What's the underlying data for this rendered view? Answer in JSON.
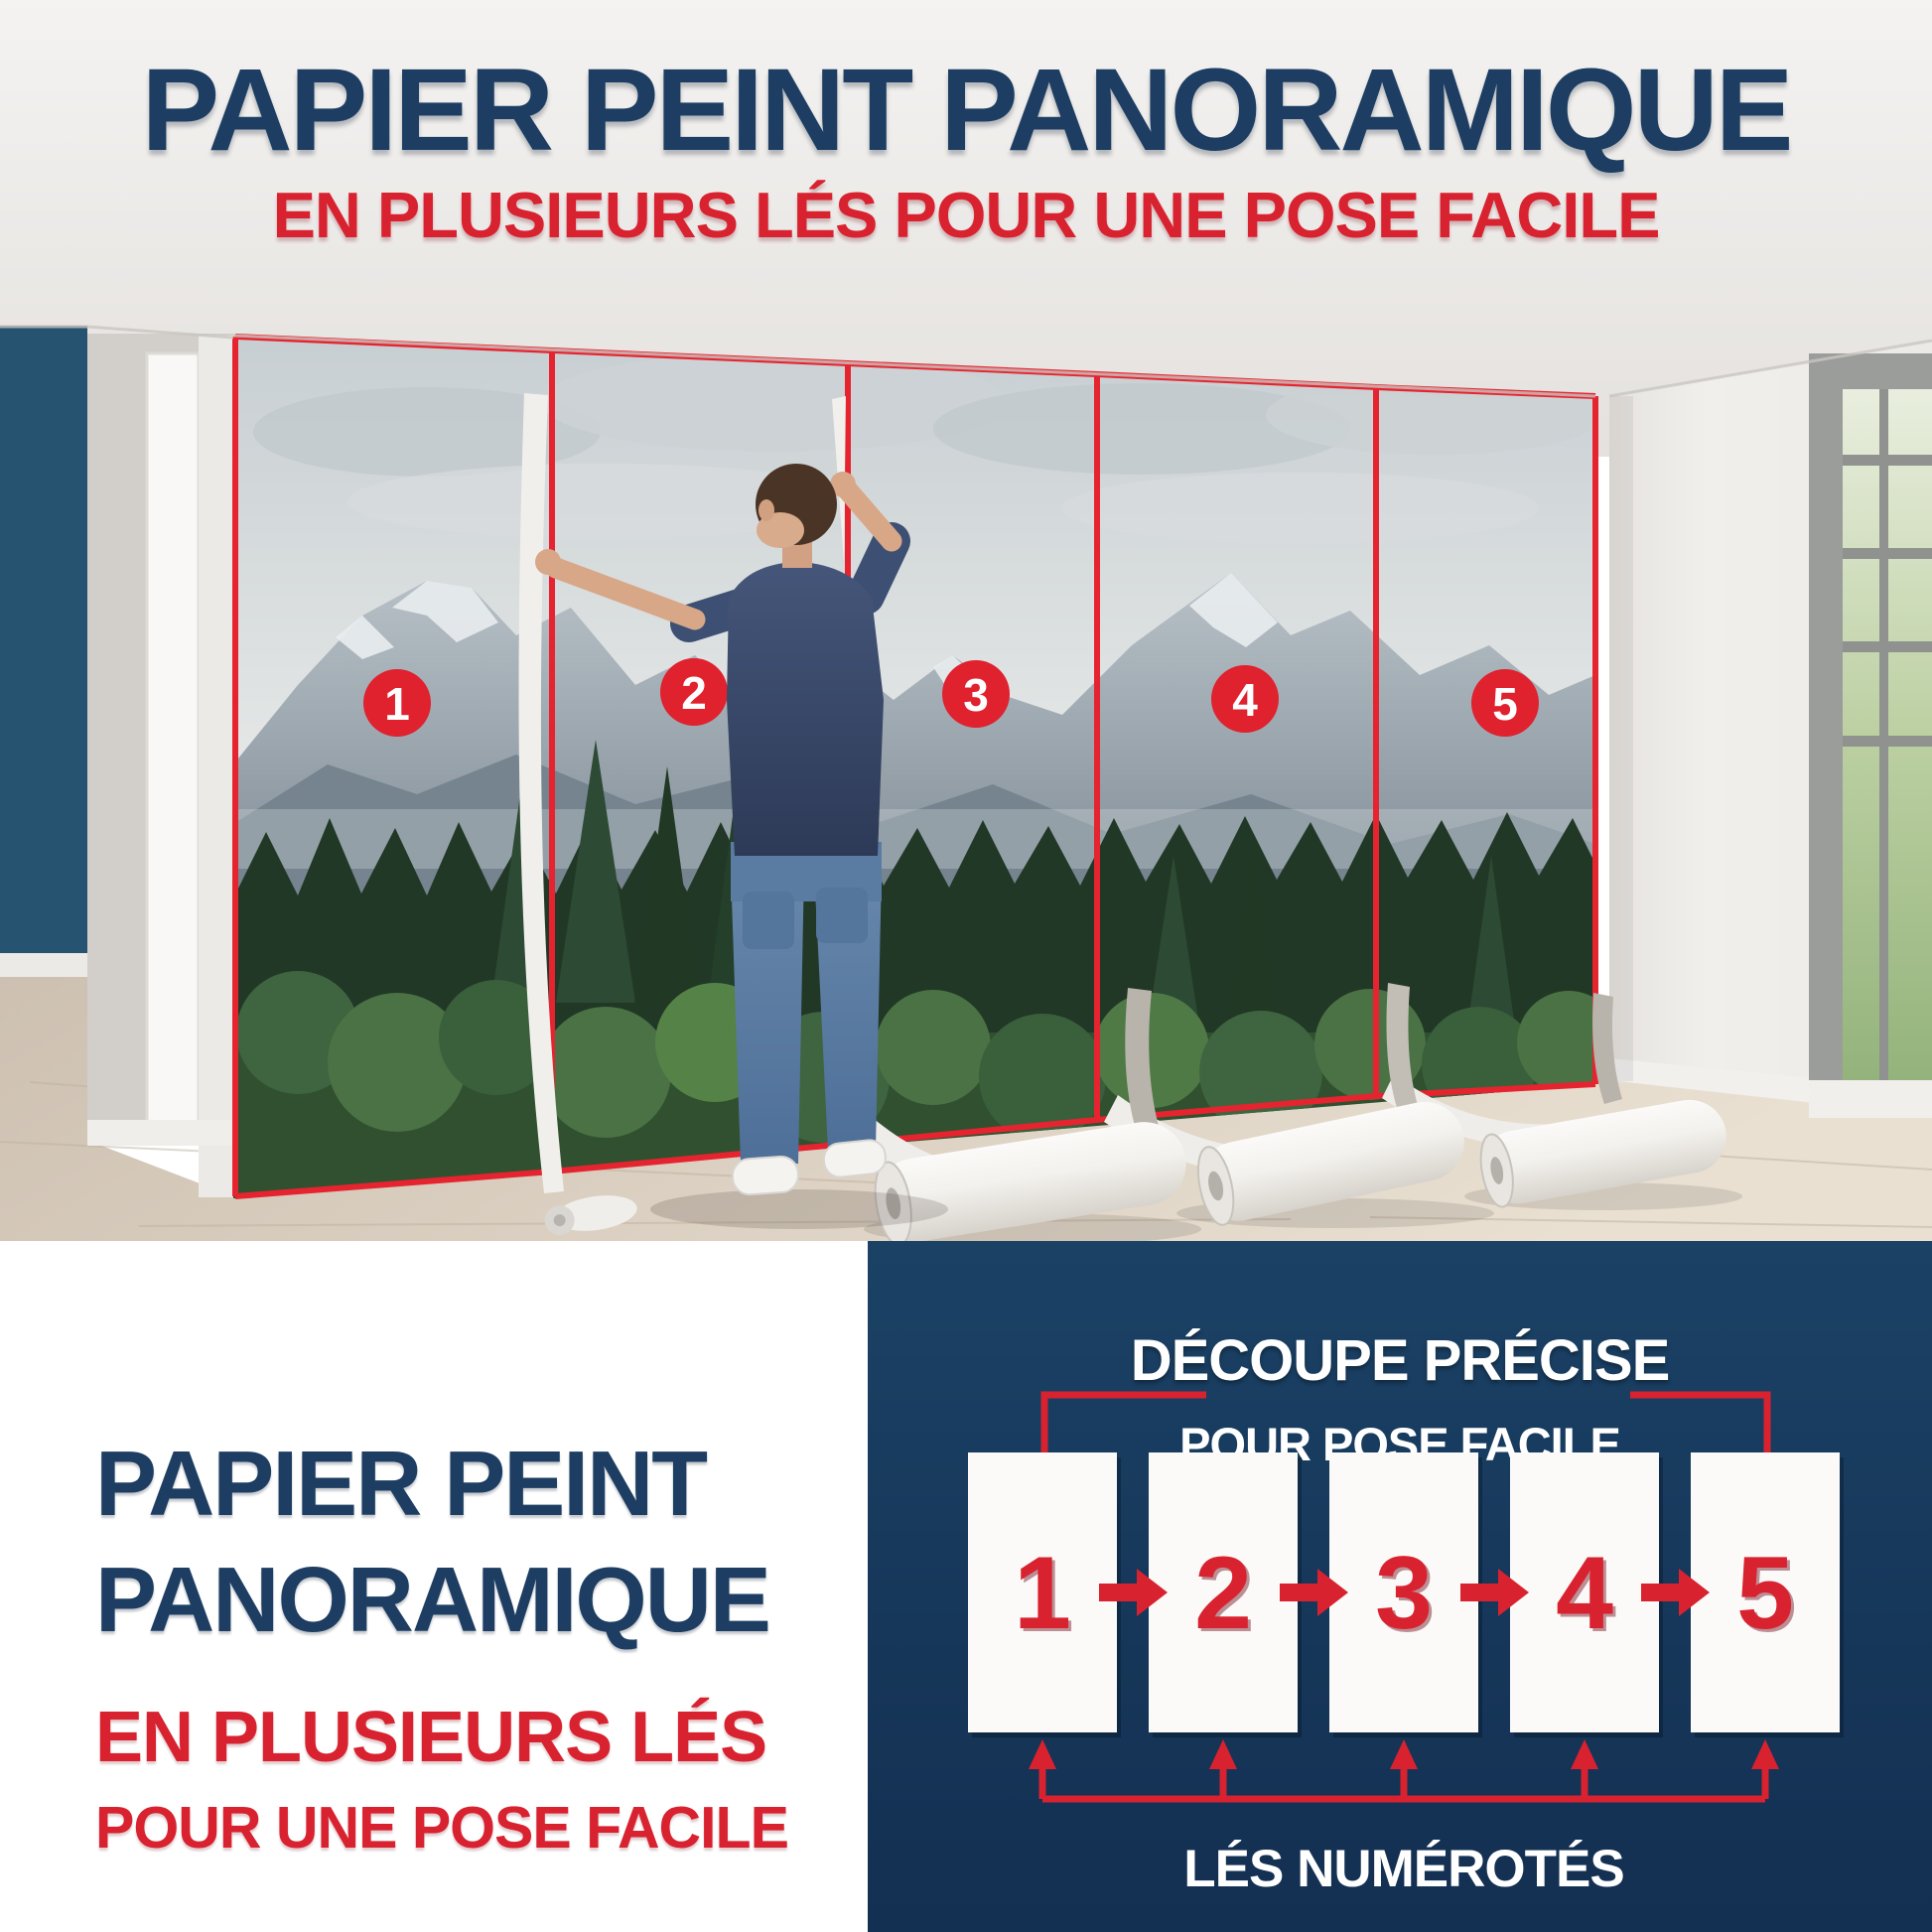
{
  "top_banner": {
    "title": "PAPIER PEINT PANORAMIQUE",
    "subtitle": "EN PLUSIEURS LÉS POUR UNE POSE FACILE"
  },
  "strips": [
    "1",
    "2",
    "3",
    "4",
    "5"
  ],
  "bottom_left": {
    "line1": "PAPIER PEINT",
    "line2": "PANORAMIQUE",
    "line3": "EN PLUSIEURS LÉS",
    "line4": "POUR UNE POSE FACILE"
  },
  "diagram": {
    "title_line1": "DÉCOUPE PRÉCISE",
    "title_line2": "POUR POSE FACILE",
    "caption": "LÉS NUMÉROTÉS"
  },
  "colors": {
    "headline_navy": "#1d3e62",
    "accent_red": "#d8222f",
    "circle_red": "#e0212e",
    "panel_navy": "#17395c",
    "accent_wall_blue": "#26536f"
  }
}
